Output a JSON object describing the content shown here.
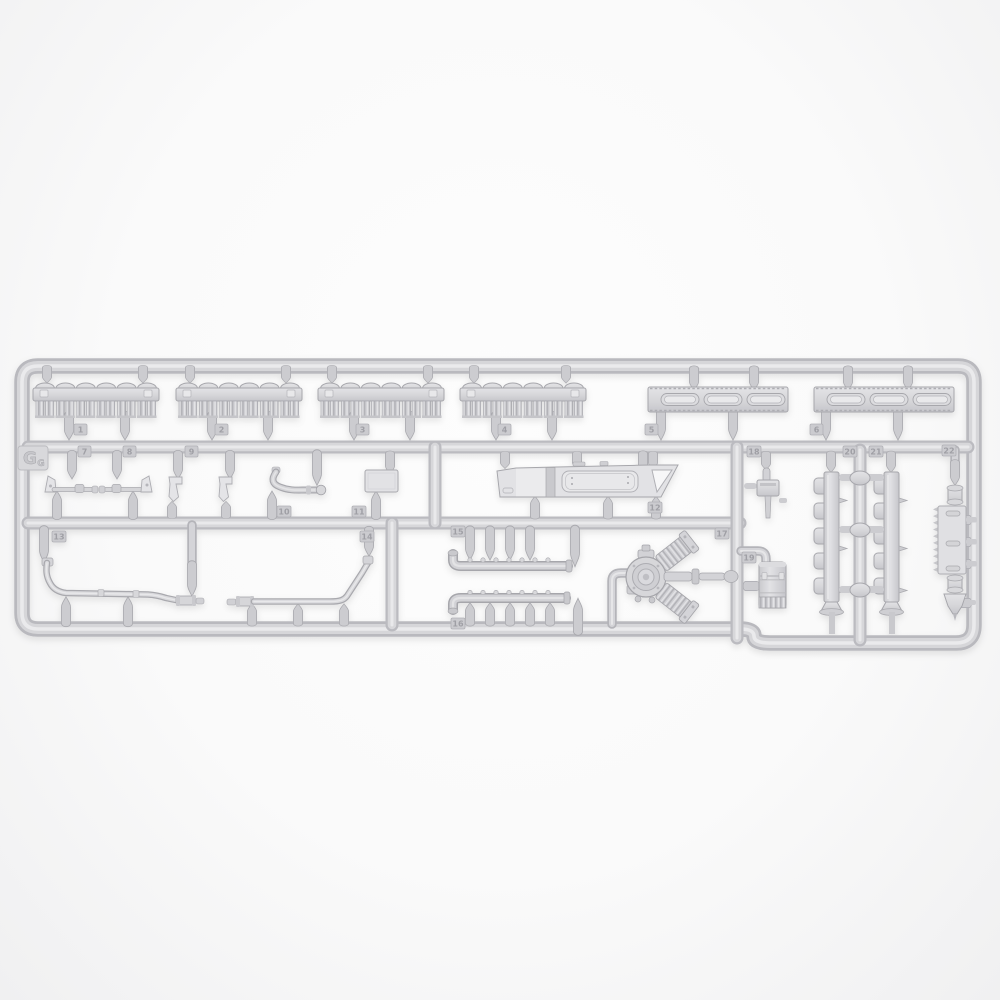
{
  "image": {
    "subject": "Injection-molded light-gray plastic model kit sprue (parts tree) photographed on a white background",
    "sprue_letter": "G"
  },
  "colors": {
    "background": "#fafafa",
    "plastic_mid": "#d6d6d9",
    "plastic_highlight": "#eaeaec",
    "plastic_shadow": "#b4b4b9",
    "outline": "#a7a7ac"
  },
  "sprue": {
    "gate_label": {
      "letter": "G",
      "sub": "G"
    },
    "part_number_tags": [
      {
        "label": "1"
      },
      {
        "label": "2"
      },
      {
        "label": "3"
      },
      {
        "label": "4"
      },
      {
        "label": "5"
      },
      {
        "label": "6"
      },
      {
        "label": "7"
      },
      {
        "label": "8"
      },
      {
        "label": "9"
      },
      {
        "label": "10"
      },
      {
        "label": "11"
      },
      {
        "label": "12"
      },
      {
        "label": "13"
      },
      {
        "label": "14"
      },
      {
        "label": "15"
      },
      {
        "label": "16"
      },
      {
        "label": "17"
      },
      {
        "label": "18"
      },
      {
        "label": "19"
      },
      {
        "label": "20"
      },
      {
        "label": "21"
      },
      {
        "label": "22"
      }
    ]
  }
}
